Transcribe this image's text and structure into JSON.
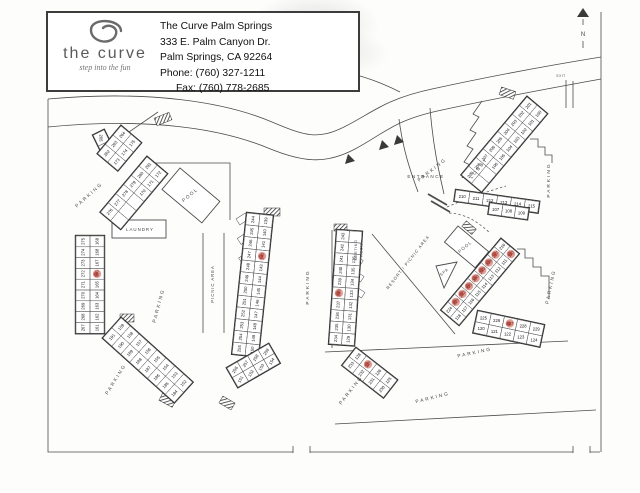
{
  "header": {
    "logo_title": "the curve",
    "logo_tagline": "step into the fun",
    "name": "The Curve Palm Springs",
    "address_line1": "333 E. Palm Canyon Dr.",
    "address_line2": "Palm Springs, CA 92264",
    "phone": "Phone: (760) 327-1211",
    "fax": "Fax: (760) 778-2685"
  },
  "map": {
    "labels": [
      {
        "id": "parking-1",
        "text": "PARKING"
      },
      {
        "id": "parking-2",
        "text": "PARKING"
      },
      {
        "id": "parking-3",
        "text": "PARKING"
      },
      {
        "id": "parking-4",
        "text": "PARKING"
      },
      {
        "id": "parking-5",
        "text": "PARKING"
      },
      {
        "id": "parking-6",
        "text": "PARKING"
      },
      {
        "id": "parking-7",
        "text": "PARKING"
      },
      {
        "id": "parking-8",
        "text": "PARKING"
      },
      {
        "id": "parking-9",
        "text": "PARKING"
      },
      {
        "id": "parking-10",
        "text": "PARKING"
      },
      {
        "id": "pool-1",
        "text": "POOL"
      },
      {
        "id": "pool-2",
        "text": "POOL"
      },
      {
        "id": "spa",
        "text": "SPA"
      },
      {
        "id": "laundry",
        "text": "LAUNDRY"
      },
      {
        "id": "entrance",
        "text": "ENTRANCE"
      },
      {
        "id": "lobby",
        "text": "LOBBY"
      },
      {
        "id": "meeting-room",
        "text": "MEETING ROOM"
      },
      {
        "id": "picnic-area",
        "text": "PICNIC AREA"
      },
      {
        "id": "resort-picnic-area",
        "text": "RESORT / PICNIC AREA"
      },
      {
        "id": "exit",
        "text": "EXIT"
      },
      {
        "id": "north",
        "text": "N"
      }
    ],
    "buildings": [
      {
        "id": "corner-a",
        "rows": [
          [
            "265",
            "176"
          ]
        ],
        "red": []
      },
      {
        "id": "west-a",
        "rows": [
          [
            "264",
            "175"
          ],
          [
            "263",
            "174"
          ],
          [
            "262",
            "173"
          ]
        ],
        "red": []
      },
      {
        "id": "west-b",
        "rows": [
          [
            "281",
            "172"
          ],
          [
            "280",
            "171"
          ],
          [
            "279",
            "170"
          ],
          [
            "278",
            ""
          ],
          [
            "277",
            ""
          ],
          [
            "276",
            ""
          ]
        ],
        "red": []
      },
      {
        "id": "west-strip",
        "rows": [
          [
            "275",
            "169"
          ],
          [
            "274",
            "168"
          ],
          [
            "273",
            "167"
          ],
          [
            "272",
            "166"
          ],
          [
            "271",
            "165"
          ],
          [
            "270",
            "164"
          ],
          [
            "269",
            "163"
          ],
          [
            "268",
            "162"
          ],
          [
            "267",
            "161"
          ]
        ],
        "red": [
          "166"
        ]
      },
      {
        "id": "southwest",
        "rows": [
          [
            "191",
            "159"
          ],
          [
            "190",
            "158"
          ],
          [
            "189",
            "157"
          ],
          [
            "188",
            "156"
          ],
          [
            "187",
            "155"
          ],
          [
            "186",
            "154"
          ],
          [
            "185",
            "153"
          ],
          [
            "184",
            "152"
          ]
        ],
        "red": []
      },
      {
        "id": "center",
        "rows": [
          [
            "244",
            "139"
          ],
          [
            "245",
            "140"
          ],
          [
            "246",
            "141"
          ],
          [
            "247",
            "142"
          ],
          [
            "248",
            "143"
          ],
          [
            "249",
            "144"
          ],
          [
            "250",
            "145"
          ],
          [
            "251",
            "146"
          ],
          [
            "252",
            "147"
          ],
          [
            "253",
            "148"
          ],
          [
            "254",
            "149"
          ],
          [
            "255",
            "150"
          ]
        ],
        "red": [
          "142"
        ]
      },
      {
        "id": "center-east",
        "rows": [
          [
            "243",
            ""
          ],
          [
            "242",
            ""
          ],
          [
            "241",
            "136"
          ],
          [
            "240",
            "135"
          ],
          [
            "239",
            "134"
          ],
          [
            "238",
            "133"
          ],
          [
            "237",
            "132"
          ],
          [
            "236",
            "131"
          ],
          [
            "235",
            "130"
          ],
          [
            "234",
            "129"
          ]
        ],
        "red": [
          "238"
        ]
      },
      {
        "id": "south-mid",
        "rows": [
          [
            "128",
            "127",
            "126",
            "125"
          ],
          [
            "233",
            "232",
            "231",
            "230"
          ]
        ],
        "red": [
          "127"
        ]
      },
      {
        "id": "south-mid-west",
        "rows": [
          [
            "256",
            "257",
            "258",
            "259"
          ],
          [
            "151",
            "152",
            "153",
            "154"
          ]
        ],
        "red": []
      },
      {
        "id": "pool-east",
        "rows": [
          [
            "216",
            "110"
          ],
          [
            "217",
            "111"
          ],
          [
            "218",
            "112"
          ],
          [
            "219",
            "113"
          ],
          [
            "220",
            "114"
          ],
          [
            "221",
            "115"
          ],
          [
            "222",
            "116"
          ],
          [
            "223",
            "117"
          ],
          [
            "224",
            "118"
          ]
        ],
        "red": [
          "110",
          "217",
          "218",
          "219",
          "220",
          "221",
          "222",
          "223"
        ]
      },
      {
        "id": "lobby-wing",
        "rows": [
          [
            "201",
            "100"
          ],
          [
            "202",
            "101"
          ],
          [
            "203",
            "102"
          ],
          [
            "204",
            "103"
          ],
          [
            "205",
            "104"
          ],
          [
            "206",
            "105"
          ],
          [
            "207",
            "106"
          ],
          [
            "208",
            ""
          ],
          [
            "209",
            ""
          ]
        ],
        "red": []
      },
      {
        "id": "lobby-tail",
        "rows": [
          [
            "210",
            "211",
            "212",
            "213",
            "214",
            "215"
          ]
        ],
        "red": []
      },
      {
        "id": "lobby-tail-b",
        "rows": [
          [
            "107",
            "108",
            "109"
          ]
        ],
        "red": []
      },
      {
        "id": "southeast",
        "rows": [
          [
            "225",
            "226",
            "227",
            "228",
            "229"
          ],
          [
            "120",
            "121",
            "122",
            "123",
            "124"
          ]
        ],
        "red": [
          "227"
        ]
      }
    ]
  }
}
